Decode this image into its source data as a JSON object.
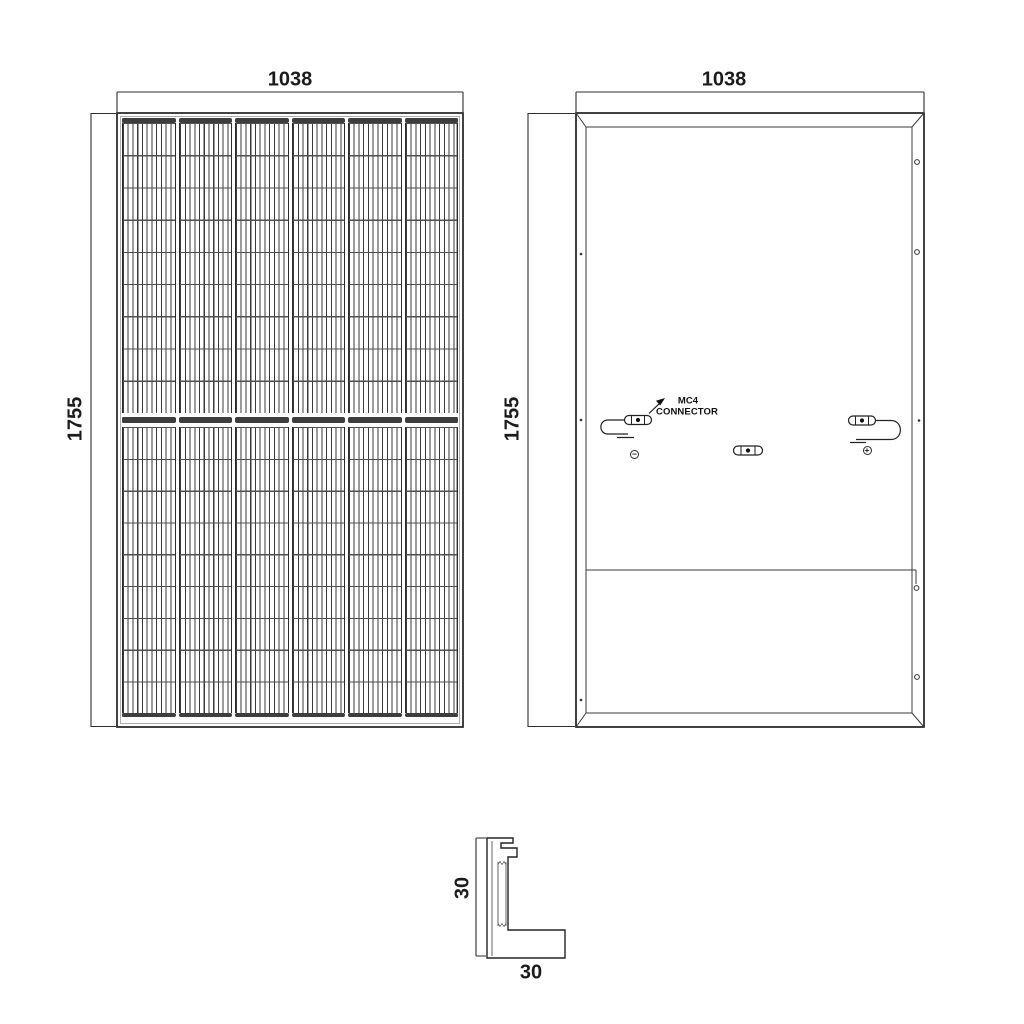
{
  "front_view": {
    "width_dim": "1038",
    "height_dim": "1755",
    "cell_columns": 6,
    "cell_rows": 18
  },
  "back_view": {
    "width_dim": "1038",
    "height_dim": "1755",
    "callout": {
      "line1": "MC4",
      "line2": "CONNECTOR"
    },
    "negative_symbol": "−",
    "positive_symbol": "+"
  },
  "frame_profile": {
    "height_dim": "30",
    "width_dim": "30"
  }
}
